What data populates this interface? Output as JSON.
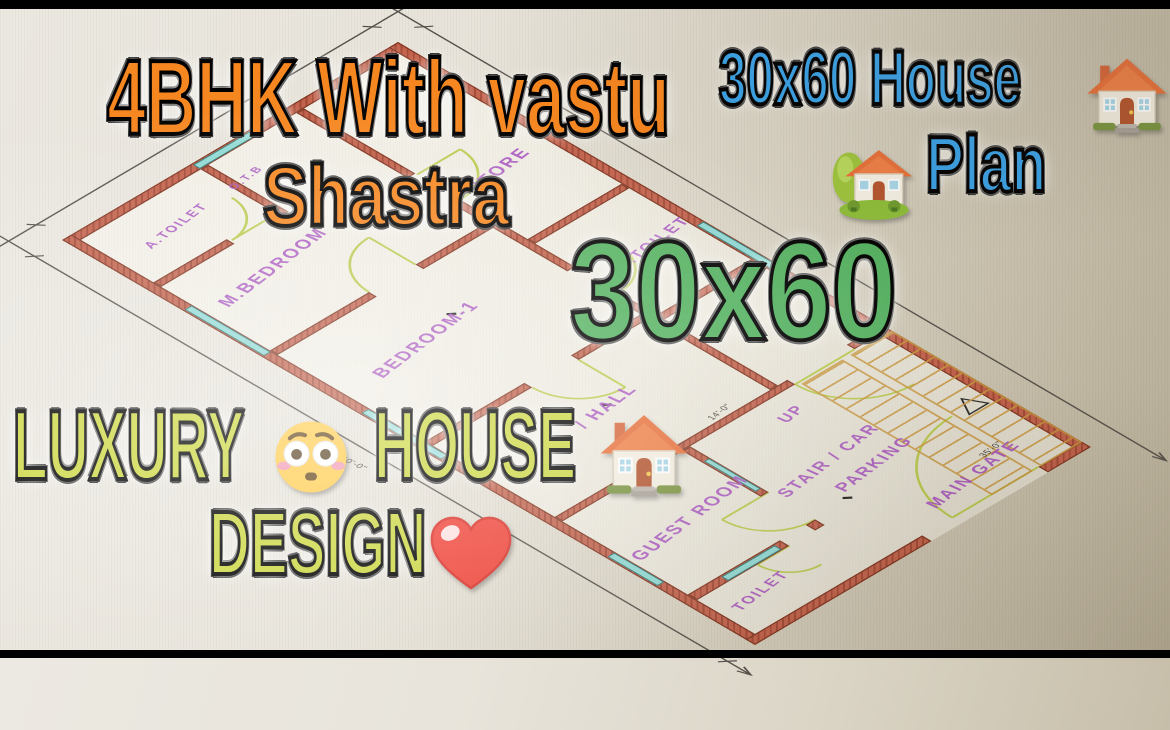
{
  "overlays": {
    "title": {
      "line1": "4BHK With vastu",
      "line2": "Shastra",
      "color": "#f6861f"
    },
    "top_right": {
      "line1": "30x60 House",
      "line2": "Plan",
      "color": "#3aa2e8"
    },
    "size_text": {
      "text": "30x60",
      "color": "#55b261"
    },
    "bottom": {
      "word1": "LUXURY",
      "word2": "HOUSE",
      "word3": "DESIGN",
      "color": "#cbd741"
    }
  },
  "icons": {
    "house": "house-emoji",
    "house_garden": "house-with-garden-emoji",
    "flushed_face": "flushed-face-emoji",
    "red_heart": "red-heart-emoji"
  },
  "floor_plan": {
    "label_color": "#a855c0",
    "wall_color": "#c2604a",
    "window_color": "#8fd9d4",
    "door_arc_color": "#b9cb4e",
    "stair_color": "#c9973e",
    "rooms": [
      {
        "id": "a-toilet",
        "label": "A.TOILET"
      },
      {
        "id": "otb",
        "label": "O.T.B"
      },
      {
        "id": "m-bedroom",
        "label": "M.BEDROOM"
      },
      {
        "id": "store",
        "label": "STORE"
      },
      {
        "id": "bedroom-1",
        "label": "BEDROOM-1"
      },
      {
        "id": "c-toilet",
        "label": "C.TOILET"
      },
      {
        "id": "hall",
        "label": "/ HALL"
      },
      {
        "id": "guest-room",
        "label": "GUEST ROOM"
      },
      {
        "id": "toilet",
        "label": "TOILET"
      },
      {
        "id": "stair-car",
        "label": "STAIR / CAR"
      },
      {
        "id": "parking",
        "label": "PARKING"
      },
      {
        "id": "up",
        "label": "UP"
      },
      {
        "id": "main-gate",
        "label": "MAIN GATE"
      }
    ],
    "dimensions": [
      "30'-0\"",
      "60'-0\"",
      "14'-0\"",
      "35'-0\""
    ]
  }
}
